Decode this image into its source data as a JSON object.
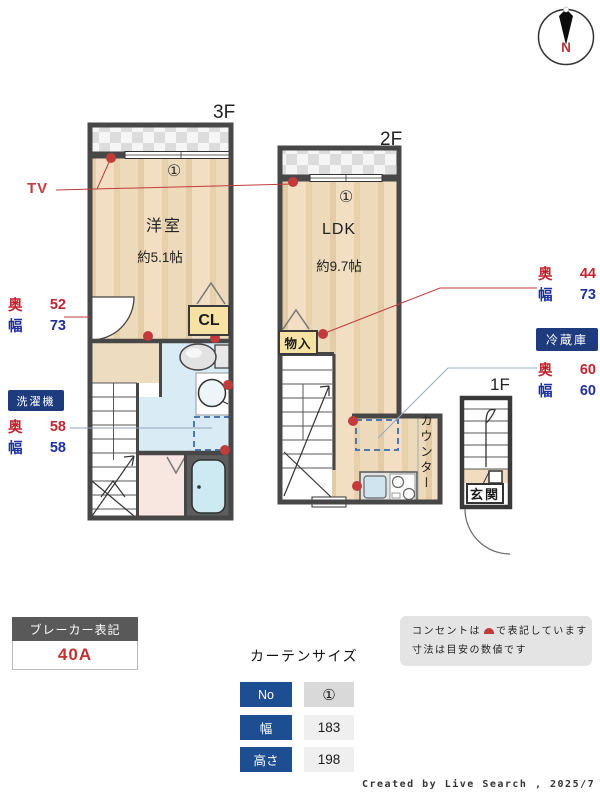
{
  "compass": {
    "north": "N"
  },
  "floor3": {
    "label": "3F",
    "window_tag": "①",
    "room_name": "洋室",
    "room_size": "約5.1帖",
    "closet_label": "CL"
  },
  "floor2": {
    "label": "2F",
    "window_tag": "①",
    "room_name": "LDK",
    "room_size": "約9.7帖",
    "storage_label": "物入",
    "counter_label": "カウンター"
  },
  "floor1": {
    "label": "1F",
    "entrance_label": "玄関"
  },
  "annotations": {
    "tv_label": "TV",
    "closet3f": {
      "depth_label": "奥",
      "depth_value": "52",
      "width_label": "幅",
      "width_value": "73"
    },
    "washer": {
      "name": "洗濯機",
      "depth_label": "奥",
      "depth_value": "58",
      "width_label": "幅",
      "width_value": "58"
    },
    "storage2f": {
      "depth_label": "奥",
      "depth_value": "44",
      "width_label": "幅",
      "width_value": "73"
    },
    "fridge": {
      "name": "冷蔵庫",
      "depth_label": "奥",
      "depth_value": "60",
      "width_label": "幅",
      "width_value": "60"
    }
  },
  "breaker": {
    "title": "ブレーカー表記",
    "value": "40A"
  },
  "curtain": {
    "title": "カーテンサイズ",
    "rows": [
      {
        "label": "No",
        "value": "①"
      },
      {
        "label": "幅",
        "value": "183"
      },
      {
        "label": "高さ",
        "value": "198"
      }
    ]
  },
  "notes": {
    "line1_before": "コンセントは",
    "line1_after": "で表記しています",
    "line2": "寸法は目安の数値です"
  },
  "credit": "Created by Live Search , 2025/7",
  "colors": {
    "outlet_dot": "#c23b3b",
    "depth_text": "#c22330",
    "width_text": "#1f2f9c",
    "tag_box": "#1e3c7d",
    "table_header": "#1d4e91",
    "floor_light": "#f2dfc3",
    "floor_dark": "#e7d0ab",
    "wall": "#474747"
  }
}
